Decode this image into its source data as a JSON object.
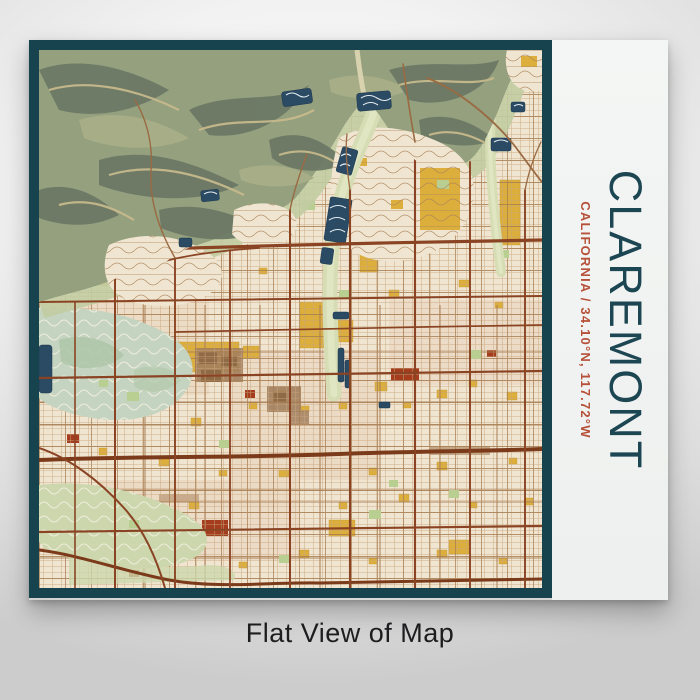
{
  "product": {
    "title": "CLAREMONT",
    "subtitle": "CALIFORNIA / 34.10°N, 117.72°W",
    "caption": "Flat View of Map"
  },
  "colors": {
    "frame_teal": "#17434f",
    "panel_white": "#f1f3f2",
    "title_teal": "#1d4653",
    "subtitle_rust": "#b65038",
    "caption_dark": "#1d1d1f",
    "map_cream": "#efe5d1",
    "map_road_brown": "#8a4423",
    "map_highway_brown": "#7b3a1a",
    "map_gold": "#dcae3c",
    "map_red_block": "#a53c1d",
    "map_terrain_green": "#94a07e",
    "map_terrain_dark": "#6c7965",
    "map_terrain_tan": "#c6b98c",
    "map_water_navy": "#2b4a63",
    "map_park_green": "#c5d4c0",
    "map_wash_green": "#d6ddb5",
    "background_gray": "#dddddd"
  }
}
